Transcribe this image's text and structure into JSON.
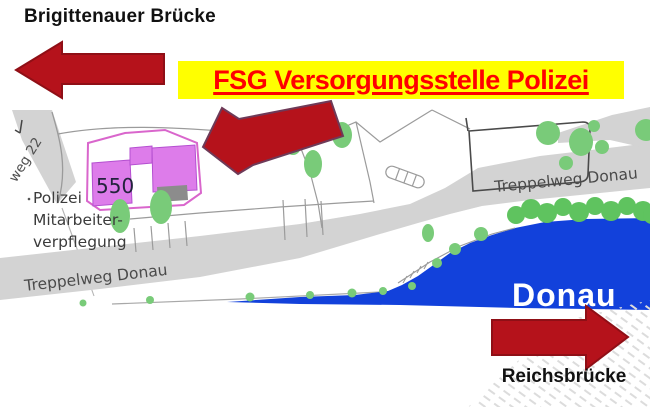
{
  "page": {
    "top_left_label": "Brigittenauer Brücke",
    "banner_label": "FSG Versorgungsstelle Polizei",
    "bottom_right_label": "Reichsbrücke"
  },
  "map": {
    "building_number": "550",
    "facility_line1": "Polizei",
    "facility_line2": "Mitarbeiter-",
    "facility_line3": "verpflegung",
    "street_partial": "weg 22",
    "road_label_left": "Treppelweg Donau",
    "road_label_right": "Treppelweg Donau",
    "river_label": "Donau"
  },
  "colors": {
    "banner_bg": "#FFFF00",
    "banner_text": "#FF0000",
    "arrow_red": "#B5121B",
    "building_fill": "#DD7CEA",
    "parcel_outline": "#D966CC",
    "river_blue": "#1241DB",
    "tree_green": "#79CB79",
    "road_gray": "#D3D3D3"
  }
}
